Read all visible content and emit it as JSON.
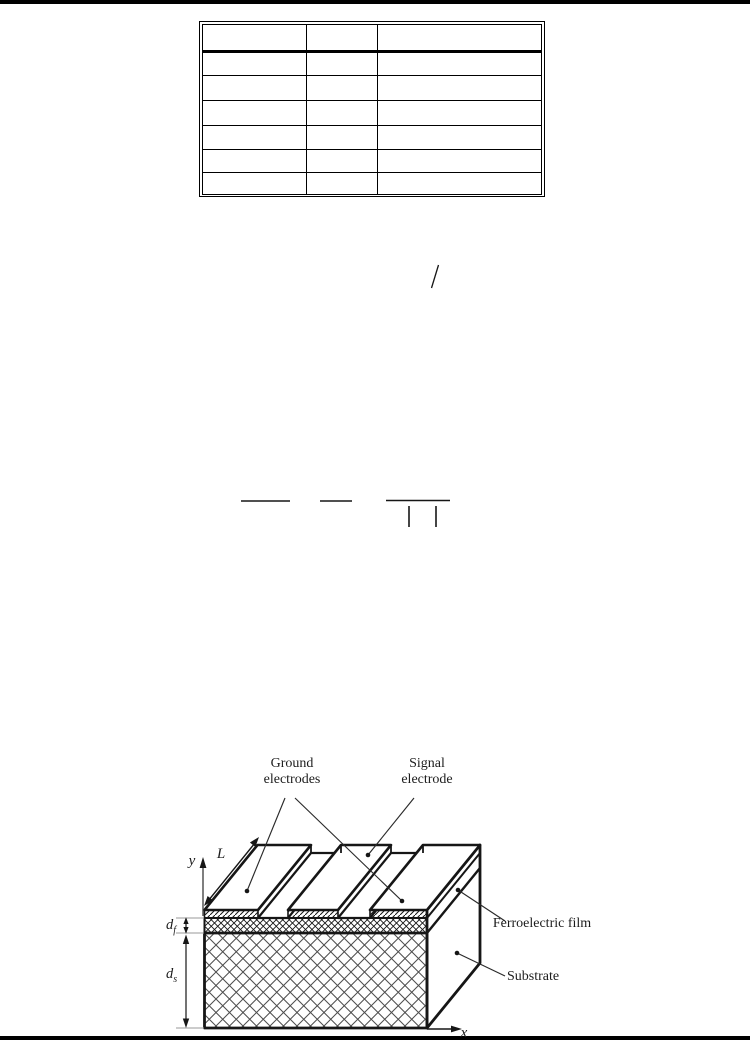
{
  "page": {
    "background": "#ffffff",
    "edge_bar_color": "#000000"
  },
  "table": {
    "columns": [
      "",
      "",
      ""
    ],
    "rows": [
      [
        "",
        "",
        ""
      ],
      [
        "",
        "",
        ""
      ],
      [
        "",
        "",
        ""
      ],
      [
        "",
        "",
        ""
      ],
      [
        "",
        "",
        ""
      ],
      [
        "",
        "",
        ""
      ]
    ]
  },
  "formula_marks": {
    "slash": "/",
    "fraction_bars": 3,
    "absolute_value_bars": 2
  },
  "diagram": {
    "labels": {
      "ground_electrodes": "Ground electrodes",
      "signal_electrode": "Signal electrode",
      "ferroelectric_film": "Ferroelectric film",
      "substrate": "Substrate",
      "axis_y": "y",
      "axis_x": "x",
      "length": "L",
      "film_thickness_base": "d",
      "film_thickness_sub": "f",
      "substrate_thickness_base": "d",
      "substrate_thickness_sub": "s"
    },
    "colors": {
      "line": "#1a1a1a",
      "extension_line": "#999999"
    }
  }
}
